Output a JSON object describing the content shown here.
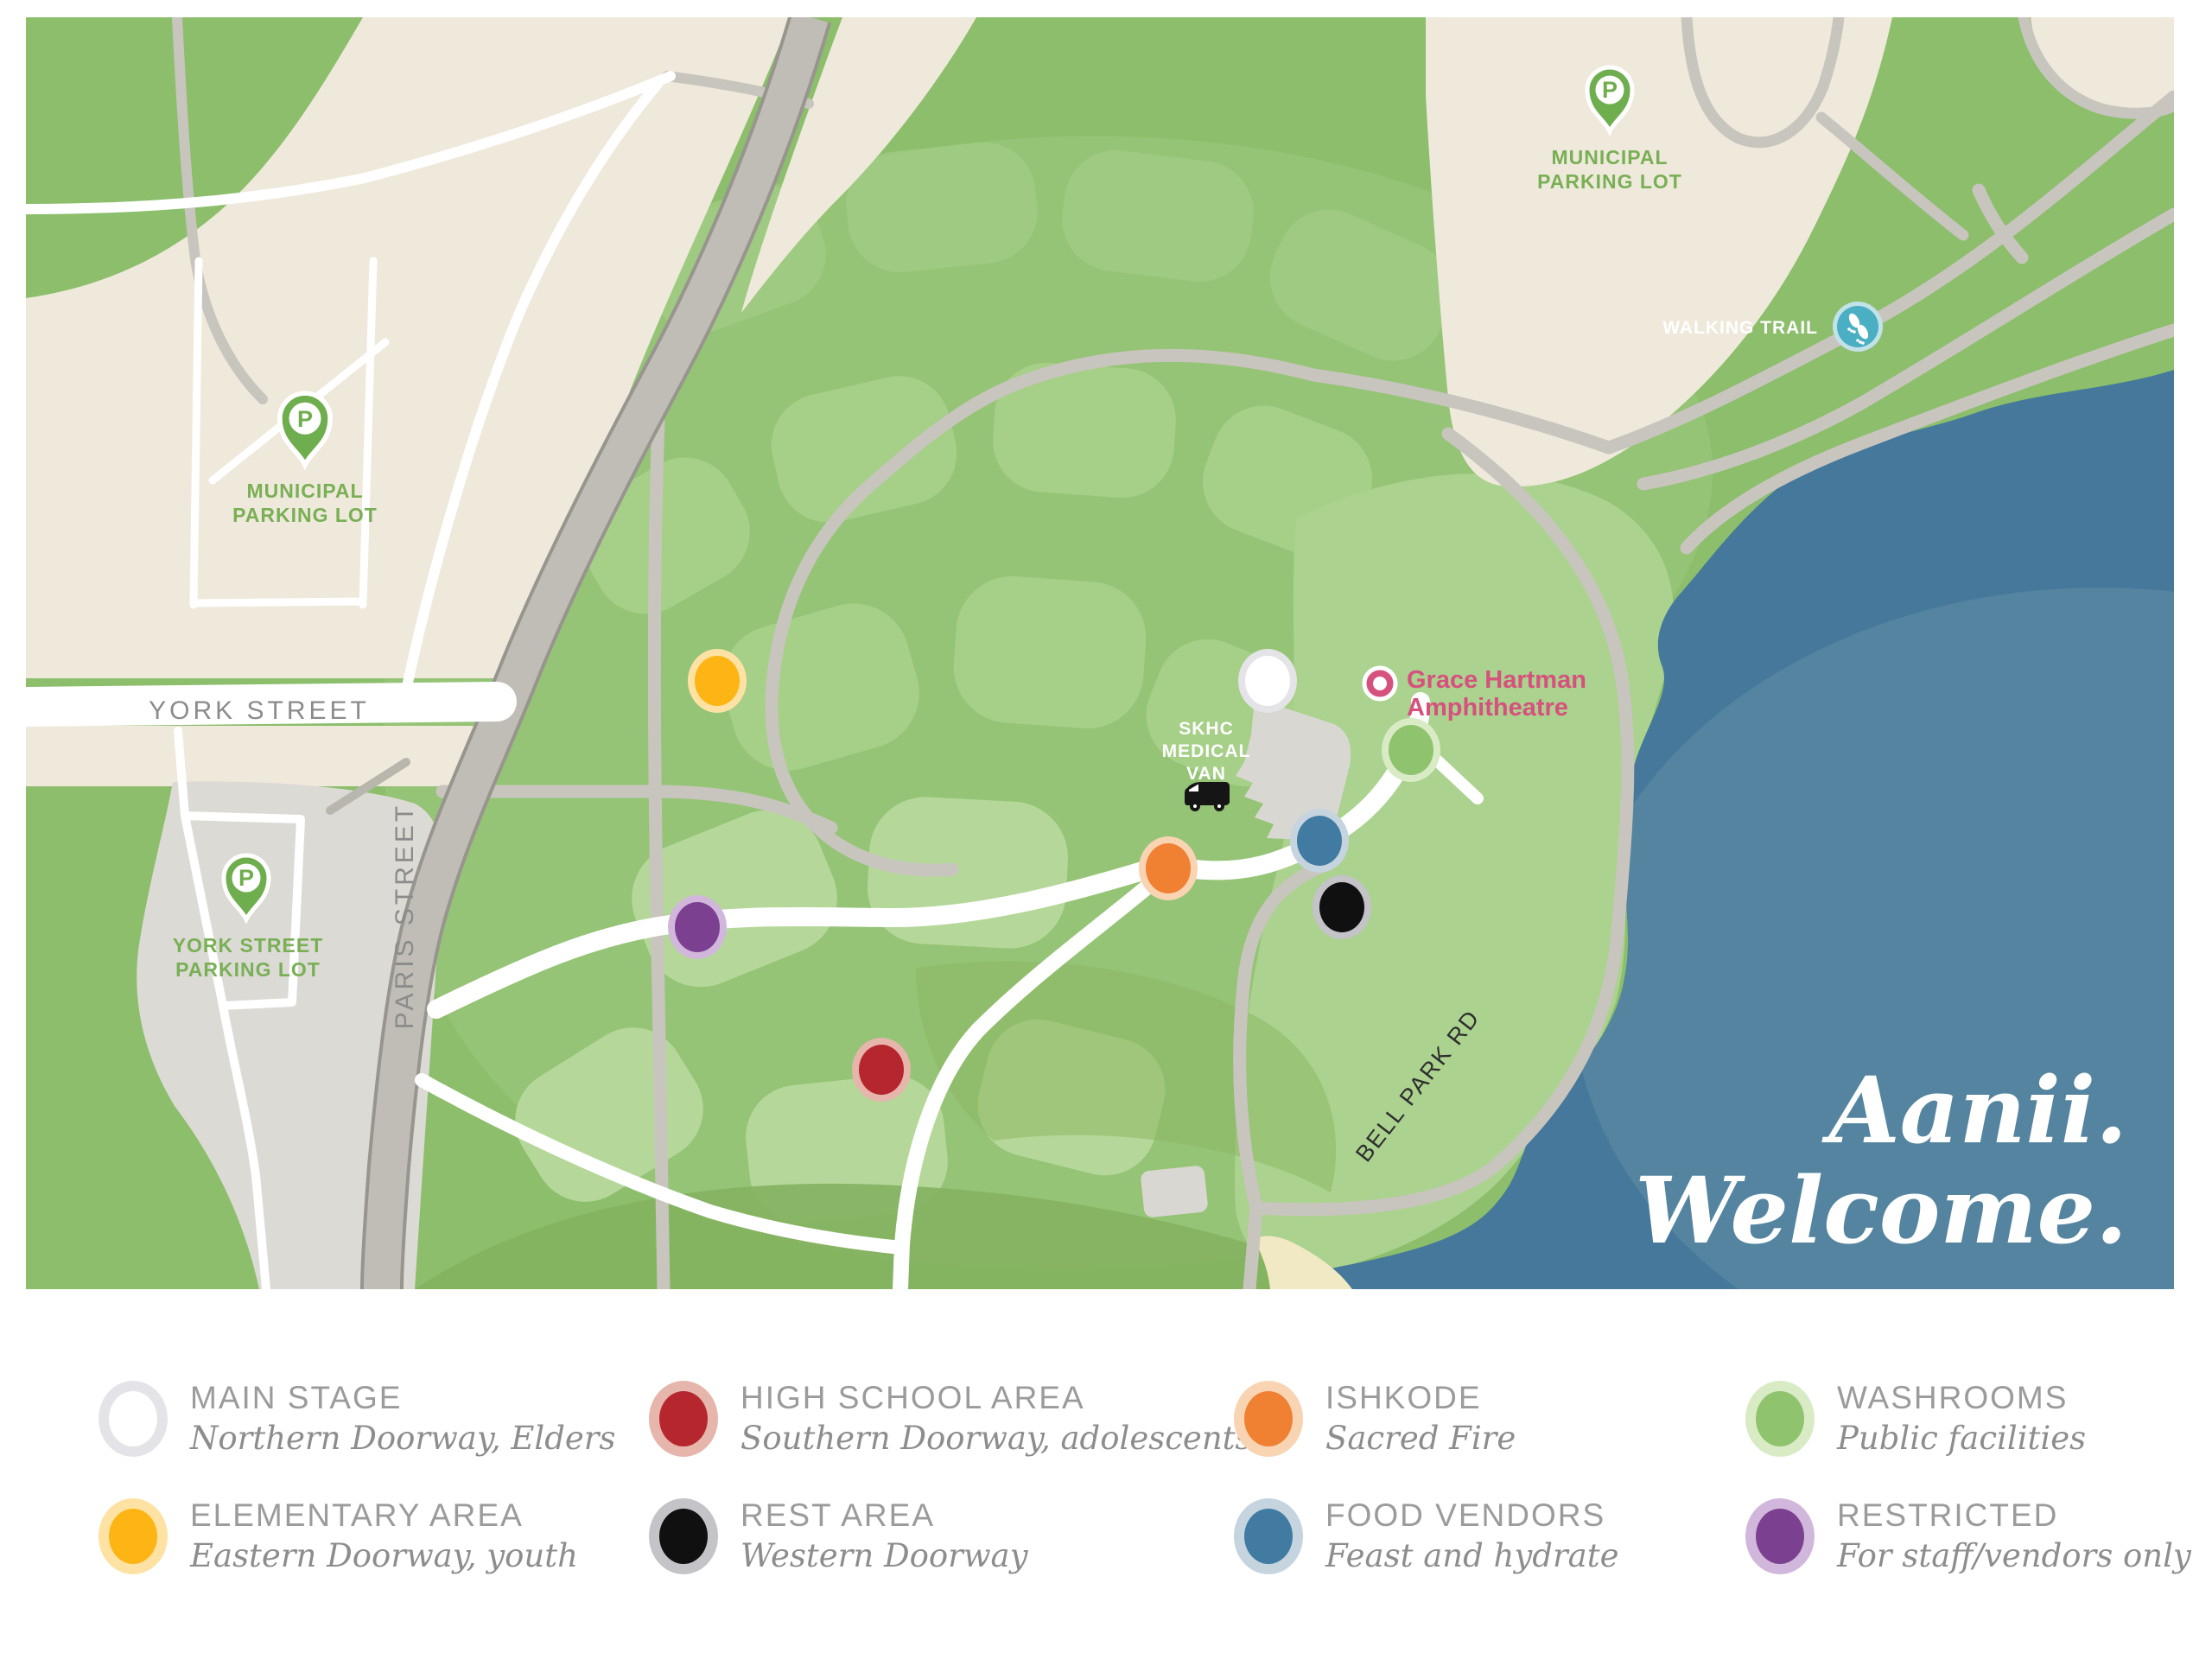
{
  "map": {
    "labels": {
      "york_street": "YORK STREET",
      "paris_street": "PARIS STREET",
      "bell_park_rd": "BELL PARK RD",
      "municipal_parking_line1": "MUNICIPAL",
      "municipal_parking_line2": "PARKING LOT",
      "york_lot_line1": "YORK STREET",
      "york_lot_line2": "PARKING LOT",
      "walking_trail": "WALKING TRAIL",
      "medical_van_line1": "SKHC",
      "medical_van_line2": "MEDICAL",
      "medical_van_line3": "VAN",
      "amphitheatre_line1": "Grace Hartman",
      "amphitheatre_line2": "Amphitheatre",
      "parking_pin_letter": "P"
    },
    "welcome": {
      "line1": "Aanii.",
      "line2": "Welcome."
    },
    "colors": {
      "water": "#45789b",
      "water_highlight": "#54849f",
      "park_green": "#8cbe6c",
      "shell_green": "#95c476",
      "scute_green": "#a6cf88",
      "peninsula_green": "#abd28e",
      "parking_beige": "#efe9db",
      "lot_gray": "#dcdad5",
      "road_gray": "#c8c5be",
      "path_white": "#ffffff",
      "pin_green": "#6fae4e",
      "amphitheatre_pink": "#d6517e",
      "walking_trail_teal": "#4aafc3"
    }
  },
  "legend": {
    "items": [
      {
        "id": "main-stage",
        "title": "MAIN STAGE",
        "subtitle": "Northern Doorway, Elders",
        "color": "#ffffff",
        "ring": "#e4e4e8"
      },
      {
        "id": "high-school-area",
        "title": "HIGH SCHOOL AREA",
        "subtitle": "Southern Doorway, adolescents",
        "color": "#b6262e",
        "ring": "#e6b5ab"
      },
      {
        "id": "ishkode",
        "title": "ISHKODE",
        "subtitle": "Sacred Fire",
        "color": "#f08032",
        "ring": "#f8d4b3"
      },
      {
        "id": "washrooms",
        "title": "WASHROOMS",
        "subtitle": "Public facilities",
        "color": "#90c36e",
        "ring": "#d8ebc5"
      },
      {
        "id": "elementary-area",
        "title": "ELEMENTARY AREA",
        "subtitle": "Eastern Doorway, youth",
        "color": "#fdb515",
        "ring": "#fee2a4"
      },
      {
        "id": "rest-area",
        "title": "REST AREA",
        "subtitle": "Western Doorway",
        "color": "#101010",
        "ring": "#c3c3c8"
      },
      {
        "id": "food-vendors",
        "title": "FOOD VENDORS",
        "subtitle": "Feast and hydrate",
        "color": "#417ba1",
        "ring": "#c5d4df"
      },
      {
        "id": "restricted",
        "title": "RESTRICTED",
        "subtitle": "For staff/vendors only",
        "color": "#7c4091",
        "ring": "#d2b7dc"
      }
    ]
  }
}
